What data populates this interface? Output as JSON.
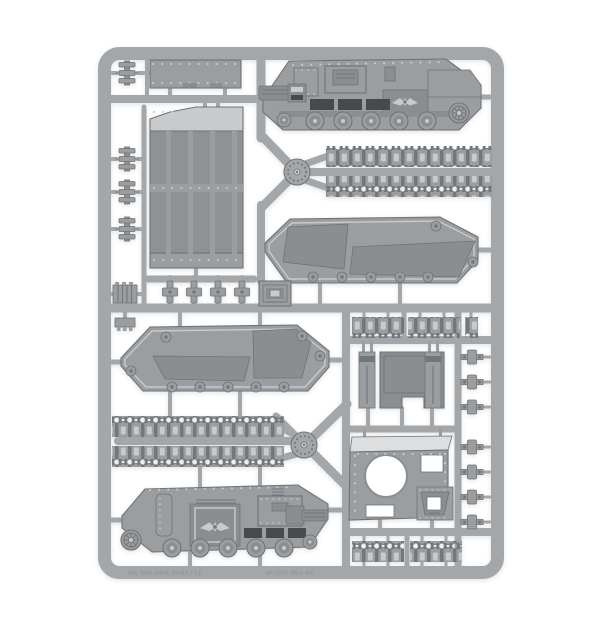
{
  "meta": {
    "description": "Photograph of a grey plastic model-kit sprue containing armoured-vehicle (tank) parts on a plain white background"
  },
  "colors": {
    "bg": "#ffffff",
    "runner": "#a4a7aa",
    "mid": "#9a9ea1",
    "dark": "#8a8e91",
    "deep": "#73777a",
    "slit": "#46494d",
    "light": "#c8cacc",
    "lighter": "#dcdee0",
    "rivet": "#c9cbcd",
    "outline": "#6f7376",
    "panel": "#8e9295"
  },
  "molded_text": {
    "left": "AW 996·HRM 3RM62 LG",
    "right": "W7050 IWG 66"
  },
  "parts": [
    "rectangular hull plate",
    "large ribbed floor panel",
    "hull side outer face with gun, hatches and road wheels (top right)",
    "hull side inner face (middle right)",
    "hull side inner face (middle left)",
    "hull side outer face with gun, eagle emblem and road wheels (bottom left)",
    "long track run x4",
    "short track section x4",
    "single track link",
    "rear ramp door with two hinge mounts",
    "top deck plate with round turret aperture and hatch",
    "small square hatch x2",
    "tow shackle bracket x4",
    "periscope block x4",
    "small fitting x7",
    "vented fitting x2",
    "sprue junction hub x2"
  ]
}
